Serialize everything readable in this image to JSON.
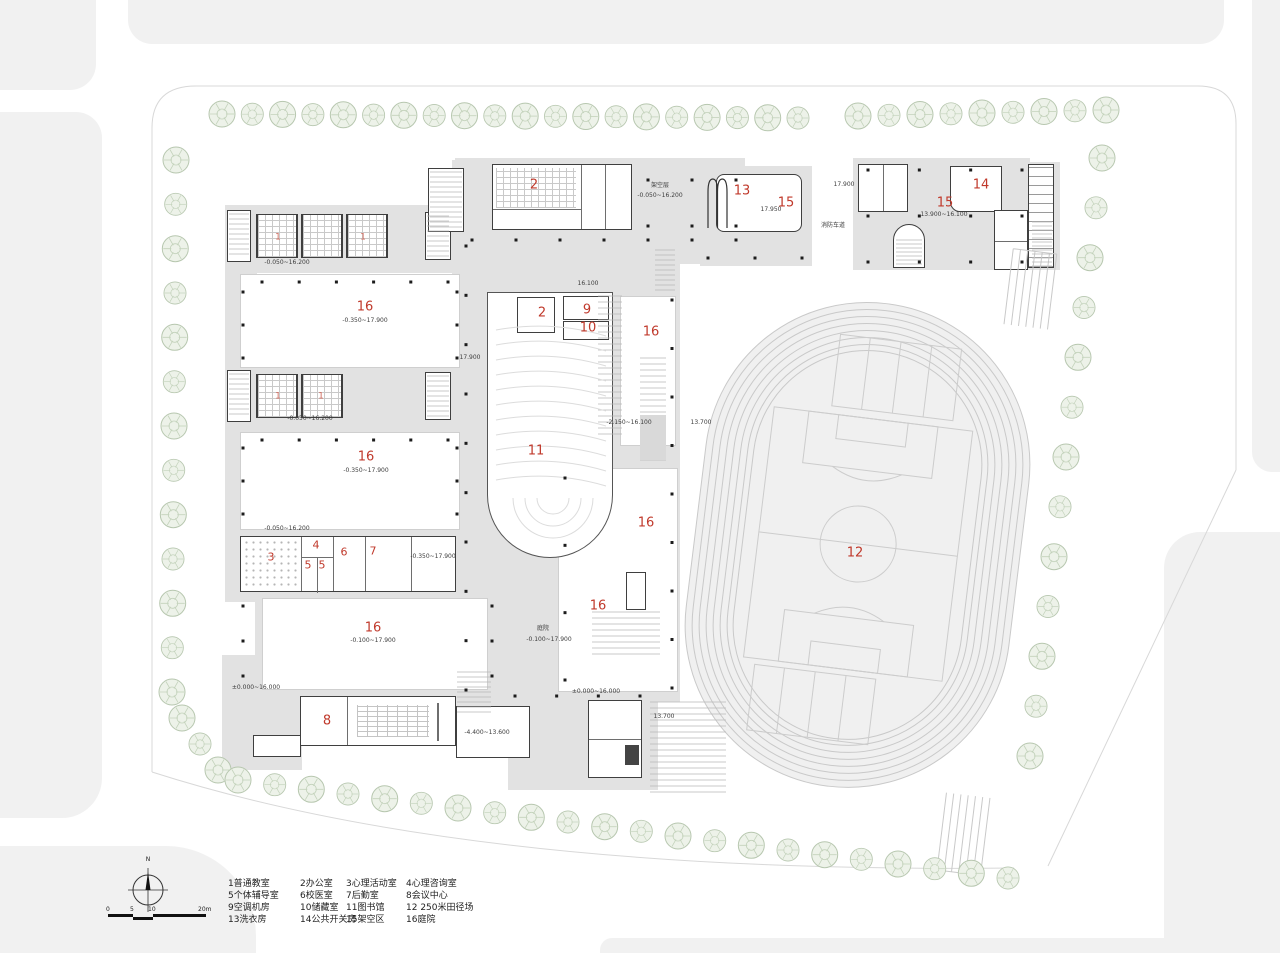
{
  "north": {
    "label": "N"
  },
  "scalebar": {
    "ticks": [
      "0",
      "5",
      "10",
      "20m"
    ]
  },
  "legend": {
    "items": [
      "1普通教室",
      "2办公室",
      "3心理活动室",
      "4心理咨询室",
      "5个体辅导室",
      "6校医室",
      "7后勤室",
      "8会议中心",
      "9空调机房",
      "10储藏室",
      "11图书馆",
      "12 250米田径场",
      "13洗衣房",
      "14公共开关房",
      "15架空区",
      "16庭院"
    ]
  },
  "plan": {
    "room_markers": [
      {
        "n": "1",
        "x": 278,
        "y": 238,
        "s": "xs"
      },
      {
        "n": "1",
        "x": 363,
        "y": 238,
        "s": "xs"
      },
      {
        "n": "1",
        "x": 278,
        "y": 397,
        "s": "xs"
      },
      {
        "n": "1",
        "x": 321,
        "y": 397,
        "s": "xs"
      },
      {
        "n": "2",
        "x": 534,
        "y": 185,
        "s": "lg"
      },
      {
        "n": "2",
        "x": 542,
        "y": 313,
        "s": "lg"
      },
      {
        "n": "3",
        "x": 271,
        "y": 557,
        "s": "sm"
      },
      {
        "n": "4",
        "x": 316,
        "y": 545,
        "s": "sm"
      },
      {
        "n": "5",
        "x": 308,
        "y": 565,
        "s": "sm"
      },
      {
        "n": "5",
        "x": 322,
        "y": 565,
        "s": "sm"
      },
      {
        "n": "6",
        "x": 344,
        "y": 552,
        "s": "sm"
      },
      {
        "n": "7",
        "x": 373,
        "y": 551,
        "s": "sm"
      },
      {
        "n": "8",
        "x": 327,
        "y": 721,
        "s": "lg"
      },
      {
        "n": "9",
        "x": 587,
        "y": 310,
        "s": "lg"
      },
      {
        "n": "10",
        "x": 588,
        "y": 328,
        "s": "lg"
      },
      {
        "n": "11",
        "x": 536,
        "y": 451,
        "s": "lg"
      },
      {
        "n": "12",
        "x": 855,
        "y": 553,
        "s": "lg"
      },
      {
        "n": "13",
        "x": 742,
        "y": 191,
        "s": "lg"
      },
      {
        "n": "14",
        "x": 981,
        "y": 185,
        "s": "lg"
      },
      {
        "n": "15",
        "x": 786,
        "y": 203,
        "s": "lg"
      },
      {
        "n": "15",
        "x": 945,
        "y": 203,
        "s": "lg"
      },
      {
        "n": "16",
        "x": 365,
        "y": 307,
        "s": "lg"
      },
      {
        "n": "16",
        "x": 366,
        "y": 457,
        "s": "lg"
      },
      {
        "n": "16",
        "x": 373,
        "y": 628,
        "s": "lg"
      },
      {
        "n": "16",
        "x": 651,
        "y": 332,
        "s": "lg"
      },
      {
        "n": "16",
        "x": 646,
        "y": 523,
        "s": "lg"
      },
      {
        "n": "16",
        "x": 598,
        "y": 606,
        "s": "lg"
      }
    ],
    "annotations": [
      {
        "t": "-0.050~16.200",
        "x": 287,
        "y": 263
      },
      {
        "t": "-0.350~17.900",
        "x": 365,
        "y": 321
      },
      {
        "t": "-0.050~16.200",
        "x": 310,
        "y": 419
      },
      {
        "t": "-0.350~17.900",
        "x": 366,
        "y": 471
      },
      {
        "t": "-0.050~16.200",
        "x": 287,
        "y": 529
      },
      {
        "t": "-0.350~17.900",
        "x": 433,
        "y": 557
      },
      {
        "t": "-0.100~17.900",
        "x": 373,
        "y": 641
      },
      {
        "t": "庭院",
        "x": 543,
        "y": 629
      },
      {
        "t": "-0.100~17.900",
        "x": 549,
        "y": 640
      },
      {
        "t": "±0.000~16.000",
        "x": 256,
        "y": 688
      },
      {
        "t": "±0.000~16.000",
        "x": 596,
        "y": 692
      },
      {
        "t": "-4.400~13.600",
        "x": 487,
        "y": 733
      },
      {
        "t": "16.100",
        "x": 588,
        "y": 284
      },
      {
        "t": "17.900",
        "x": 470,
        "y": 358
      },
      {
        "t": "-2.150~16.100",
        "x": 629,
        "y": 423
      },
      {
        "t": "13.700",
        "x": 701,
        "y": 423
      },
      {
        "t": "13.700",
        "x": 664,
        "y": 717
      },
      {
        "t": "架空层",
        "x": 660,
        "y": 186
      },
      {
        "t": "-0.050~16.200",
        "x": 660,
        "y": 196
      },
      {
        "t": "17.950",
        "x": 771,
        "y": 210
      },
      {
        "t": "17.900",
        "x": 844,
        "y": 185
      },
      {
        "t": "消防车道",
        "x": 833,
        "y": 226
      },
      {
        "t": "13.900~16.100",
        "x": 944,
        "y": 215
      }
    ]
  }
}
